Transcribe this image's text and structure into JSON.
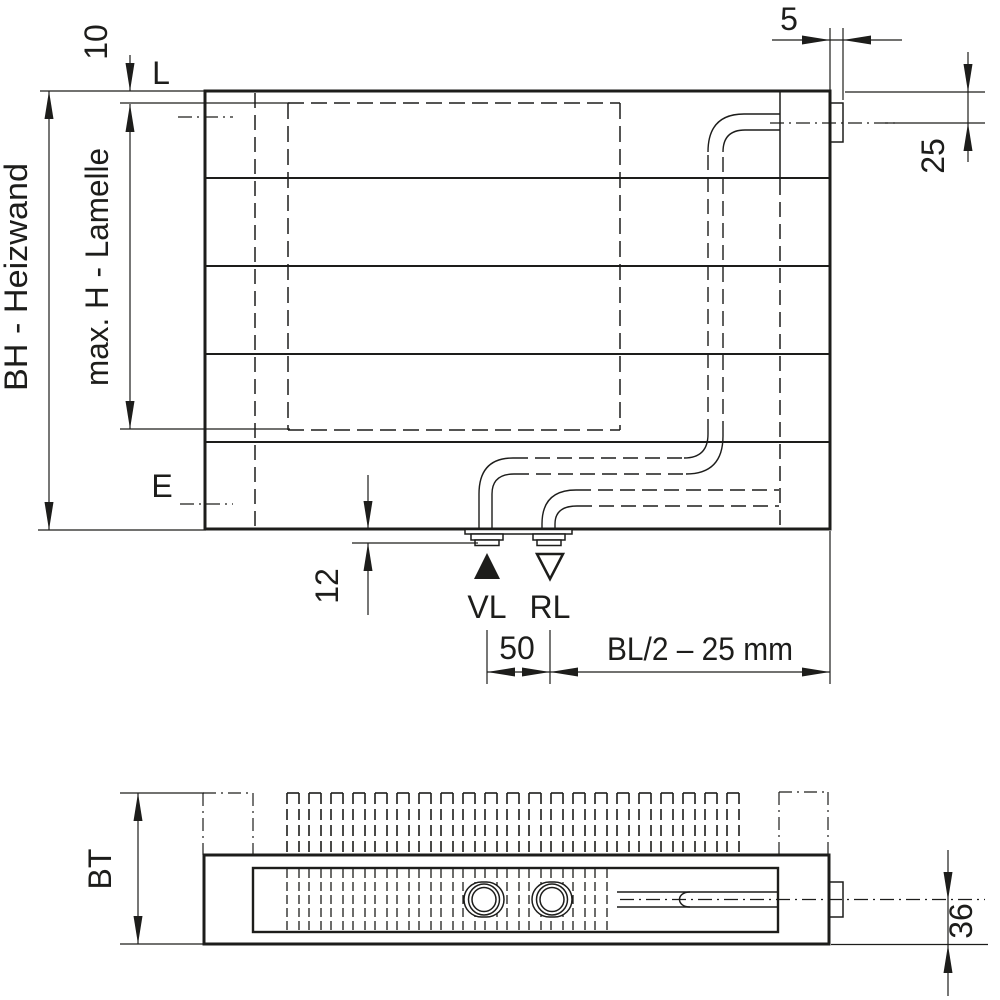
{
  "colors": {
    "line": "#1d1d1b",
    "background": "#ffffff"
  },
  "front_view": {
    "dims": {
      "top_offset": "10",
      "top_level_label": "L",
      "vent_width": "5",
      "vent_center_offset": "25",
      "overall_height": "BH - Heizwand",
      "lamelle_height": "max. H - Lamelle",
      "bottom_level_label": "E",
      "stub_drop": "12",
      "supply_label": "VL",
      "return_label": "RL",
      "connection_pitch": "50",
      "connection_position": "BL/2 – 25 mm"
    }
  },
  "plan_view": {
    "dims": {
      "depth": "BT",
      "pipe_axis_offset": "36"
    }
  }
}
